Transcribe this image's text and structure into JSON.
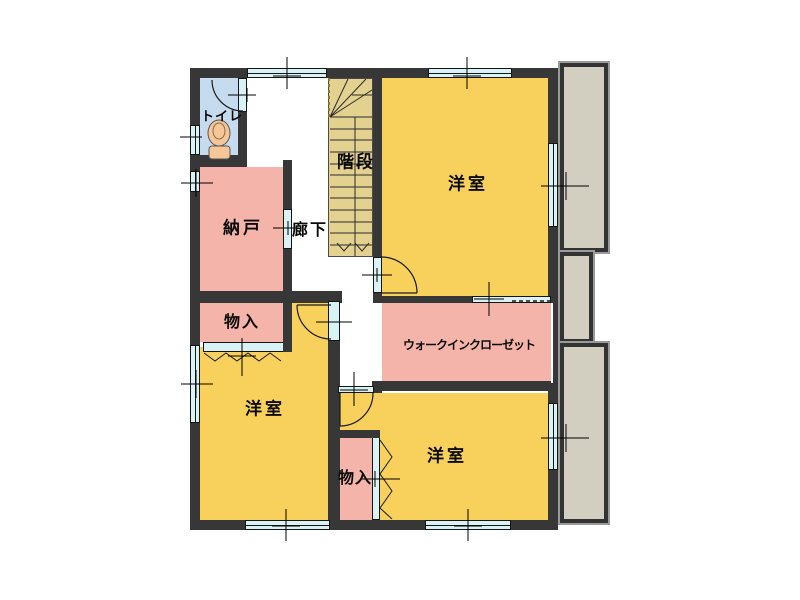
{
  "plan": {
    "rooms": {
      "toilet": {
        "label": "トイレ"
      },
      "storage": {
        "label": "納戸"
      },
      "hallway": {
        "label": "廊下"
      },
      "stairs": {
        "label": "階段"
      },
      "bedroom_ne": {
        "label": "洋室"
      },
      "walk_in_closet": {
        "label": "ウォークインクローゼット"
      },
      "bedroom_sw": {
        "label": "洋室"
      },
      "bedroom_se": {
        "label": "洋室"
      },
      "closet_nw": {
        "label": "物入"
      },
      "closet_s": {
        "label": "物入"
      }
    },
    "colors": {
      "room_yellow": "#F8D15C",
      "room_pink": "#F5B4AA",
      "toilet_blue": "#C7DBEF",
      "stairs_tan": "#E3D190",
      "balcony_gray": "#D2CFC1",
      "wall_dark": "#373737",
      "opening_blue": "#D9F2F6",
      "background": "#FFFFFF"
    }
  }
}
